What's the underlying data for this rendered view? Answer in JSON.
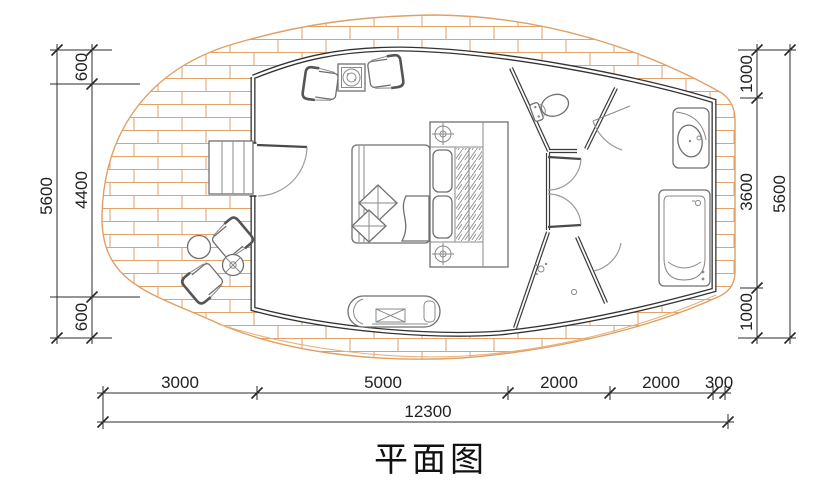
{
  "title": "平面图",
  "drawing": {
    "type": "architectural-floor-plan",
    "colors": {
      "deck_brick": "#e2a268",
      "wall": "#333333",
      "furniture": "#6f6f6f",
      "dimension_text": "#222222"
    }
  },
  "dimensions": {
    "left": {
      "overall": "5600",
      "segments": [
        "600",
        "4400",
        "600"
      ]
    },
    "right": {
      "overall": "5600",
      "segments": [
        "1000",
        "3600",
        "1000"
      ]
    },
    "bottom": {
      "overall": "12300",
      "segments": [
        "3000",
        "5000",
        "2000",
        "2000",
        "300"
      ]
    }
  }
}
